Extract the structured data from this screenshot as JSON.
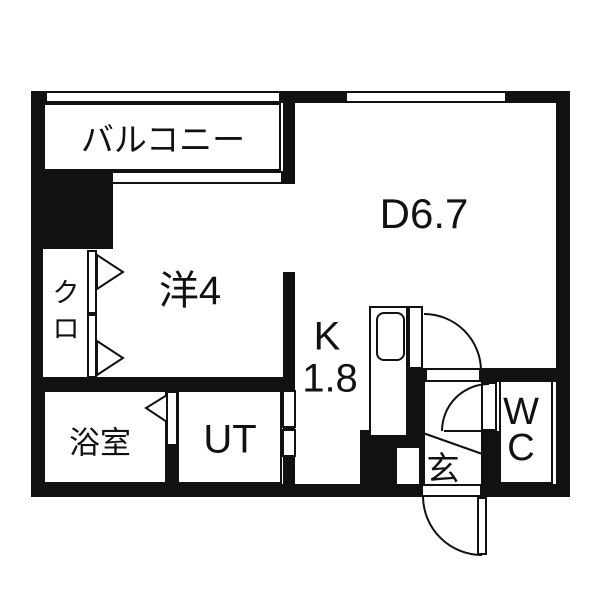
{
  "colors": {
    "wall": "#111111",
    "background": "#ffffff"
  },
  "rooms": {
    "balcony": {
      "label": "バルコニー"
    },
    "dining": {
      "label": "D6.7"
    },
    "western_room": {
      "label": "洋4"
    },
    "closet": {
      "label": "クロ",
      "line1": "ク",
      "line2": "ロ"
    },
    "kitchen": {
      "label": "K 1.8",
      "letter": "K",
      "size": "1.8"
    },
    "bathroom": {
      "label": "浴室"
    },
    "utility": {
      "label": "UT"
    },
    "entrance": {
      "label": "玄"
    },
    "toilet": {
      "label": "WC",
      "line1": "W",
      "line2": "C"
    }
  }
}
